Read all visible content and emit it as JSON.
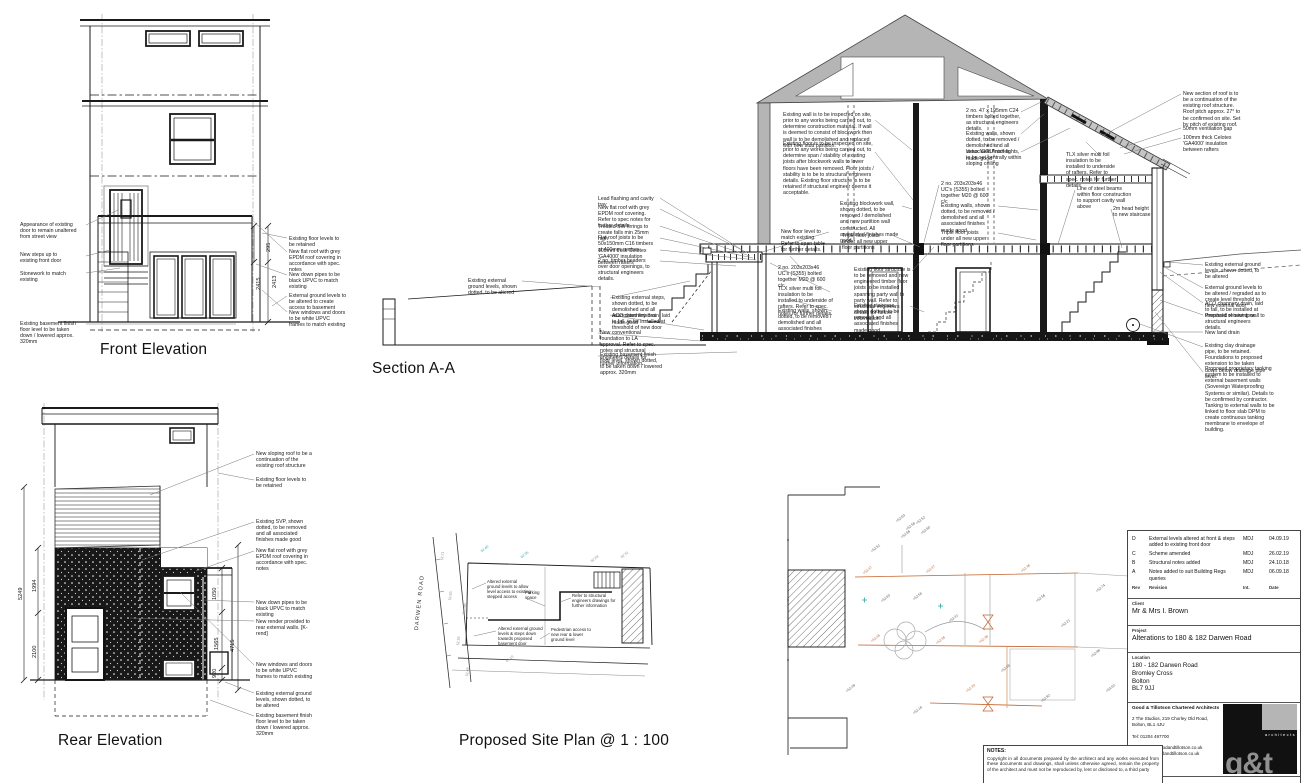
{
  "labels": {
    "front": "Front Elevation",
    "section": "Section A-A",
    "rear": "Rear Elevation",
    "site": "Proposed Site Plan @ 1 : 100",
    "road": "DARWEN ROAD"
  },
  "front": {
    "annotations": [
      {
        "text": "Appearance of existing door to remain unaltered from street view",
        "x": 20,
        "y": 222,
        "w": 60
      },
      {
        "text": "New steps up to existing front door",
        "x": 20,
        "y": 252,
        "w": 55
      },
      {
        "text": "Stonework to match existing",
        "x": 20,
        "y": 271,
        "w": 62
      },
      {
        "text": "Existing basement finish floor level to be taken down / lowered approx. 320mm",
        "x": 20,
        "y": 321,
        "w": 58
      },
      {
        "text": "Existing floor levels to be retained",
        "x": 289,
        "y": 236,
        "w": 55
      },
      {
        "text": "New flat roof with grey EPDM roof covering in accordance with spec. notes",
        "x": 289,
        "y": 249,
        "w": 60
      },
      {
        "text": "New down pipes to be black UPVC to match existing",
        "x": 289,
        "y": 272,
        "w": 58
      },
      {
        "text": "External ground levels to be altered to create access to basement",
        "x": 289,
        "y": 293,
        "w": 62
      },
      {
        "text": "New windows and doors to be white UPVC frames to match existing",
        "x": 289,
        "y": 310,
        "w": 58
      }
    ],
    "dims": [
      {
        "text": "295",
        "x": 266,
        "y": 252,
        "rot": -90
      },
      {
        "text": "2415",
        "x": 256,
        "y": 290,
        "rot": -90
      },
      {
        "text": "2413",
        "x": 272,
        "y": 288,
        "rot": -90
      }
    ]
  },
  "section": {
    "annotations": [
      {
        "text": "Lead flashing and cavity tray",
        "x": 598,
        "y": 196,
        "w": 58
      },
      {
        "text": "New flat roof with grey EPDM roof covering. Refer to spec notes for further details",
        "x": 598,
        "y": 205,
        "w": 58
      },
      {
        "text": "Treated SW firrings to create falls min 25mm high",
        "x": 598,
        "y": 224,
        "w": 55
      },
      {
        "text": "Flat roof joists to be 50x150mm C16 timbers at 400mm centres",
        "x": 598,
        "y": 235,
        "w": 58
      },
      {
        "text": "100mm thick Celotex 'GA4000' insulation between rafters",
        "x": 598,
        "y": 248,
        "w": 58
      },
      {
        "text": "2 no. timber headers over door openings, to structural engineers details.",
        "x": 598,
        "y": 258,
        "w": 55
      },
      {
        "text": "Existing external ground levels, shown dotted, to be altered",
        "x": 468,
        "y": 278,
        "w": 55
      },
      {
        "text": "Existing external steps, shown dotted, to be demolished and all associated finishes made good",
        "x": 612,
        "y": 295,
        "w": 58
      },
      {
        "text": "ACO channery drain, laid to fall, to be installed at threshold of new door",
        "x": 612,
        "y": 313,
        "w": 58
      },
      {
        "text": "New conventional foundation to LA approval. Refer to spec. notes and structural engineers details for further information.",
        "x": 600,
        "y": 330,
        "w": 60
      },
      {
        "text": "Existing basement finish floor level, shown dotted, to be taken down / lowered approx. 320mm",
        "x": 600,
        "y": 352,
        "w": 62
      },
      {
        "text": "Existing wall is to be inspected on site, prior to any works being carried out, to determine construction material. If wall is deemed to consist of blockwork then wall is to be demolished and replaced with new stud partition.",
        "x": 783,
        "y": 112,
        "w": 90
      },
      {
        "text": "Existing floor is to be inspected on site, prior to any works being carried out, to determine span / stability of existing joists after blockwork walls to lower floors have been removed. Floor joists / stability is to be to structural engineers details. Existing floor structure is to be retained if structural engineer deems it acceptable.",
        "x": 783,
        "y": 141,
        "w": 92
      },
      {
        "text": "New floor level to match existing. Refer to span table for further details.",
        "x": 781,
        "y": 229,
        "w": 48
      },
      {
        "text": "Existing blockwork wall, shown dotted, to be removed / demolished and new partition wall constructed. All associated finishes made good.",
        "x": 840,
        "y": 201,
        "w": 60
      },
      {
        "text": "Triple floor joists under all new upper floor partitions",
        "x": 842,
        "y": 233,
        "w": 52
      },
      {
        "text": "2 no. 203x203x46 UC's (S355) bolted together M20 @ 600 c/c",
        "x": 778,
        "y": 265,
        "w": 50
      },
      {
        "text": "TLX silver multi foil insulation to be installed to underside of rafters. Refer to spec. notes for further details.",
        "x": 778,
        "y": 286,
        "w": 55
      },
      {
        "text": "Existing walls, shown dotted, to be removed / demolished and all associated finishes made good",
        "x": 778,
        "y": 308,
        "w": 58
      },
      {
        "text": "Existing floor structure is to be removed and new engineered timber floor joists to be installed spanning party wall to party wall. Refer to structural engineers details for further information.",
        "x": 854,
        "y": 267,
        "w": 58
      },
      {
        "text": "Existing staircase, shown dotted, to be removed and all associated finishes made good",
        "x": 854,
        "y": 303,
        "w": 55
      },
      {
        "text": "2 no. 203x203x46 UC's (S355) bolted together M20 @ 600 c/c",
        "x": 941,
        "y": 181,
        "w": 50
      },
      {
        "text": "Existing walls, shown dotted, to be removed / demolished and all associated finishes made good",
        "x": 941,
        "y": 203,
        "w": 55
      },
      {
        "text": "Triple floor joists under all new upper floor partitions",
        "x": 941,
        "y": 230,
        "w": 52
      },
      {
        "text": "2 no. 47 x 195mm C24 timbers bolted together, as structural engineers details.",
        "x": 966,
        "y": 108,
        "w": 55
      },
      {
        "text": "Existing walls, shown dotted, to be removed / demolished and all associated finishes made good",
        "x": 966,
        "y": 131,
        "w": 58
      },
      {
        "text": "Velux 'GGU' roof lights, to be set centrally within sloping ceiling",
        "x": 966,
        "y": 149,
        "w": 58
      },
      {
        "text": "New section of roof is to be a continuation of the existing roof structure. Roof pitch approx. 27° to be confirmed on site. Set by pitch of existing roof.",
        "x": 1183,
        "y": 91,
        "w": 62
      },
      {
        "text": "50mm ventilation gap",
        "x": 1183,
        "y": 126,
        "w": 60
      },
      {
        "text": "100mm thick Celotex 'GA4000' insulation between rafters",
        "x": 1183,
        "y": 135,
        "w": 60
      },
      {
        "text": "TLX silver multi foil insulation to be installed to underside of rafters. Refer to spec. notes for further details.",
        "x": 1066,
        "y": 152,
        "w": 52
      },
      {
        "text": "Line of steel beams within floor construction to support cavity wall above",
        "x": 1077,
        "y": 186,
        "w": 55
      },
      {
        "text": "2m head height to new staircase",
        "x": 1113,
        "y": 206,
        "w": 40
      },
      {
        "text": "Existing external ground levels, shown dotted, to be altered",
        "x": 1205,
        "y": 262,
        "w": 60
      },
      {
        "text": "External ground levels to be altered / regraded as to create level threshold to new external door",
        "x": 1205,
        "y": 285,
        "w": 62
      },
      {
        "text": "ACO channery drain, laid to fall, to be installed at threshold of new door",
        "x": 1205,
        "y": 301,
        "w": 62
      },
      {
        "text": "Proposed retaining wall to structural engineers details.",
        "x": 1205,
        "y": 313,
        "w": 60
      },
      {
        "text": "New land drain",
        "x": 1205,
        "y": 330,
        "w": 50
      },
      {
        "text": "Existing clay drainage pipe, to be retained. Foundations to proposed extension to be taken down below drainage pipe level.",
        "x": 1205,
        "y": 343,
        "w": 62
      },
      {
        "text": "Proposed proprietary tanking system to be installed to external basement walls (Sovereign Waterproofing Systems or similar). Details to be confirmed by contractor. Tanking to external walls to be linked to floor slab DPM to create continuous tanking membrane to envelope of building.",
        "x": 1205,
        "y": 366,
        "w": 75
      }
    ]
  },
  "rear": {
    "annotations": [
      {
        "text": "New sloping roof to be a continuation of the existing roof structure",
        "x": 256,
        "y": 451,
        "w": 60
      },
      {
        "text": "Existing floor levels to be retained",
        "x": 256,
        "y": 477,
        "w": 55
      },
      {
        "text": "Existing SVP, shown dotted, to be removed and all associated finishes made good",
        "x": 256,
        "y": 519,
        "w": 60
      },
      {
        "text": "New flat roof with grey EPDM roof covering in accordance with spec. notes",
        "x": 256,
        "y": 548,
        "w": 60
      },
      {
        "text": "New down pipes to be black UPVC to match existing",
        "x": 256,
        "y": 600,
        "w": 58
      },
      {
        "text": "New render provided to rear external walls. [K-rend]",
        "x": 256,
        "y": 619,
        "w": 58
      },
      {
        "text": "New windows and doors to be white UPVC frames to match existing",
        "x": 256,
        "y": 662,
        "w": 58
      },
      {
        "text": "Existing external ground levels, shown dotted, to be altered",
        "x": 256,
        "y": 691,
        "w": 60
      },
      {
        "text": "Existing basement finish floor level to be taken down / lowered approx. 320mm",
        "x": 256,
        "y": 713,
        "w": 60
      }
    ],
    "dims": [
      {
        "text": "5249",
        "x": 18,
        "y": 600,
        "rot": -90
      },
      {
        "text": "1994",
        "x": 32,
        "y": 592,
        "rot": -90
      },
      {
        "text": "2100",
        "x": 32,
        "y": 658,
        "rot": -90
      },
      {
        "text": "1050",
        "x": 212,
        "y": 600,
        "rot": -90
      },
      {
        "text": "1565",
        "x": 214,
        "y": 650,
        "rot": -90
      },
      {
        "text": "920",
        "x": 212,
        "y": 678,
        "rot": -90
      },
      {
        "text": "4715",
        "x": 230,
        "y": 652,
        "rot": -90
      }
    ]
  },
  "site": {
    "annotations": [
      {
        "text": "Altered external ground levels to allow level access to existing stepped access",
        "x": 487,
        "y": 579,
        "w": 44,
        "fs": 4.3
      },
      {
        "text": "Parking space",
        "x": 525,
        "y": 590,
        "w": 26,
        "fs": 4.3
      },
      {
        "text": "Refer to structural engineers drawings for further information",
        "x": 572,
        "y": 593,
        "w": 44,
        "fs": 4.3
      },
      {
        "text": "Altered external ground levels & steps down towards proposed basement door",
        "x": 498,
        "y": 626,
        "w": 46,
        "fs": 4.3
      },
      {
        "text": "Pedestrian access to new rear & lower ground level",
        "x": 551,
        "y": 627,
        "w": 42,
        "fs": 4.3
      }
    ],
    "spots": [
      {
        "text": "+52.47",
        "x": 862,
        "y": 572,
        "rot": -38,
        "c": "#c4622d"
      },
      {
        "text": "+52.47",
        "x": 925,
        "y": 571,
        "rot": -38,
        "c": "#c4622d"
      },
      {
        "text": "+52.36",
        "x": 1020,
        "y": 570,
        "rot": -38,
        "c": "#c4622d"
      },
      {
        "text": "+52.63",
        "x": 880,
        "y": 600,
        "rot": -38,
        "c": "#555"
      },
      {
        "text": "+52.55",
        "x": 912,
        "y": 598,
        "rot": -38,
        "c": "#555"
      },
      {
        "text": "+52.41",
        "x": 948,
        "y": 620,
        "rot": -38,
        "c": "#555"
      },
      {
        "text": "+52.45",
        "x": 870,
        "y": 640,
        "rot": -38,
        "c": "#c4622d"
      },
      {
        "text": "+52.46",
        "x": 935,
        "y": 642,
        "rot": -38,
        "c": "#c4622d"
      },
      {
        "text": "+52.38",
        "x": 978,
        "y": 641,
        "rot": -38,
        "c": "#c4622d"
      },
      {
        "text": "+52.56",
        "x": 1035,
        "y": 600,
        "rot": -38,
        "c": "#555"
      },
      {
        "text": "+52.21",
        "x": 1060,
        "y": 625,
        "rot": -38,
        "c": "#555"
      },
      {
        "text": "+52.74",
        "x": 1095,
        "y": 590,
        "rot": -38,
        "c": "#555"
      },
      {
        "text": "+52.88",
        "x": 1090,
        "y": 655,
        "rot": -38,
        "c": "#555"
      },
      {
        "text": "+53.02",
        "x": 1105,
        "y": 690,
        "rot": -38,
        "c": "#555"
      },
      {
        "text": "+52.92",
        "x": 1040,
        "y": 700,
        "rot": -38,
        "c": "#555"
      },
      {
        "text": "+52.05",
        "x": 1000,
        "y": 670,
        "rot": -38,
        "c": "#555"
      },
      {
        "text": "+52.33",
        "x": 965,
        "y": 690,
        "rot": -38,
        "c": "#c4622d"
      },
      {
        "text": "+52.18",
        "x": 912,
        "y": 712,
        "rot": -38,
        "c": "#555"
      },
      {
        "text": "+52.49",
        "x": 845,
        "y": 690,
        "rot": -38,
        "c": "#555"
      },
      {
        "text": "+52.61",
        "x": 870,
        "y": 550,
        "rot": -38,
        "c": "#555"
      },
      {
        "text": "+52.63",
        "x": 895,
        "y": 520,
        "rot": -38,
        "c": "#555"
      },
      {
        "text": "+52.58",
        "x": 905,
        "y": 528,
        "rot": -38,
        "c": "#555"
      },
      {
        "text": "+52.52",
        "x": 915,
        "y": 522,
        "rot": -38,
        "c": "#555"
      },
      {
        "text": "+52.66",
        "x": 900,
        "y": 536,
        "rot": -38,
        "c": "#555"
      },
      {
        "text": "+52.60",
        "x": 920,
        "y": 532,
        "rot": -38,
        "c": "#555"
      },
      {
        "text": "52.71",
        "x": 440,
        "y": 560,
        "rot": -84,
        "c": "#888"
      },
      {
        "text": "52.63",
        "x": 448,
        "y": 600,
        "rot": -84,
        "c": "#888"
      },
      {
        "text": "Tarmac",
        "x": 462,
        "y": 614,
        "rot": -84,
        "c": "#888"
      },
      {
        "text": "52.55",
        "x": 456,
        "y": 645,
        "rot": -84,
        "c": "#888"
      },
      {
        "text": "52.49",
        "x": 465,
        "y": 676,
        "rot": -84,
        "c": "#888"
      },
      {
        "text": "52.40",
        "x": 480,
        "y": 550,
        "rot": -38,
        "c": "#2aa5a5"
      },
      {
        "text": "52.35",
        "x": 520,
        "y": 556,
        "rot": -38,
        "c": "#2aa5a5"
      },
      {
        "text": "45.10",
        "x": 505,
        "y": 660,
        "rot": -38,
        "c": "#888"
      },
      {
        "text": "52.28",
        "x": 590,
        "y": 560,
        "rot": -38,
        "c": "#888"
      },
      {
        "text": "52.31",
        "x": 620,
        "y": 556,
        "rot": -38,
        "c": "#888"
      }
    ]
  },
  "titleblock": {
    "revisions": [
      {
        "rev": "D",
        "desc": "External levels altered at front & steps added to existing front door",
        "int": "MDJ",
        "date": "04.09.19"
      },
      {
        "rev": "C",
        "desc": "Scheme amended",
        "int": "MDJ",
        "date": "26.02.19"
      },
      {
        "rev": "B",
        "desc": "Structural notes added",
        "int": "MDJ",
        "date": "24.10.18"
      },
      {
        "rev": "A",
        "desc": "Notes added to suit Building Regs queries",
        "int": "MDJ",
        "date": "06.09.18"
      }
    ],
    "rev_header": {
      "rev": "Rev",
      "desc": "Revision",
      "int": "Int.",
      "date": "Date"
    },
    "client_label": "Client",
    "client": "Mr & Mrs I. Brown",
    "project_label": "Project",
    "project": "Alterations to 180 & 182 Darwen Road",
    "location_label": "Location",
    "location_lines": [
      "180 - 182 Darwen Road",
      "Bromley Cross",
      "Bolton",
      "BL7 9JJ"
    ],
    "practice_name": "Good & Tillotson Chartered Architects",
    "practice_address": "2 The Studios, 219 Chorley Old Road, Bolton, BL1 4JU",
    "tel": "Tel: 01204 497700",
    "email": "Email: info@goodandtillotson.co.uk",
    "web": "Web: www.goodandtillotson.co.uk",
    "logo_text": "g&t",
    "logo_sub": "architects",
    "drawing_title_label": "Drawing Title"
  },
  "notes": {
    "title": "NOTES:",
    "body": "Copyright in all documents prepared by the architect and any works executed from these documents and drawings, shall unless otherwise agreed, remain the property of the architect and must not be reproduced by, lent or disclosed to, a third party"
  }
}
